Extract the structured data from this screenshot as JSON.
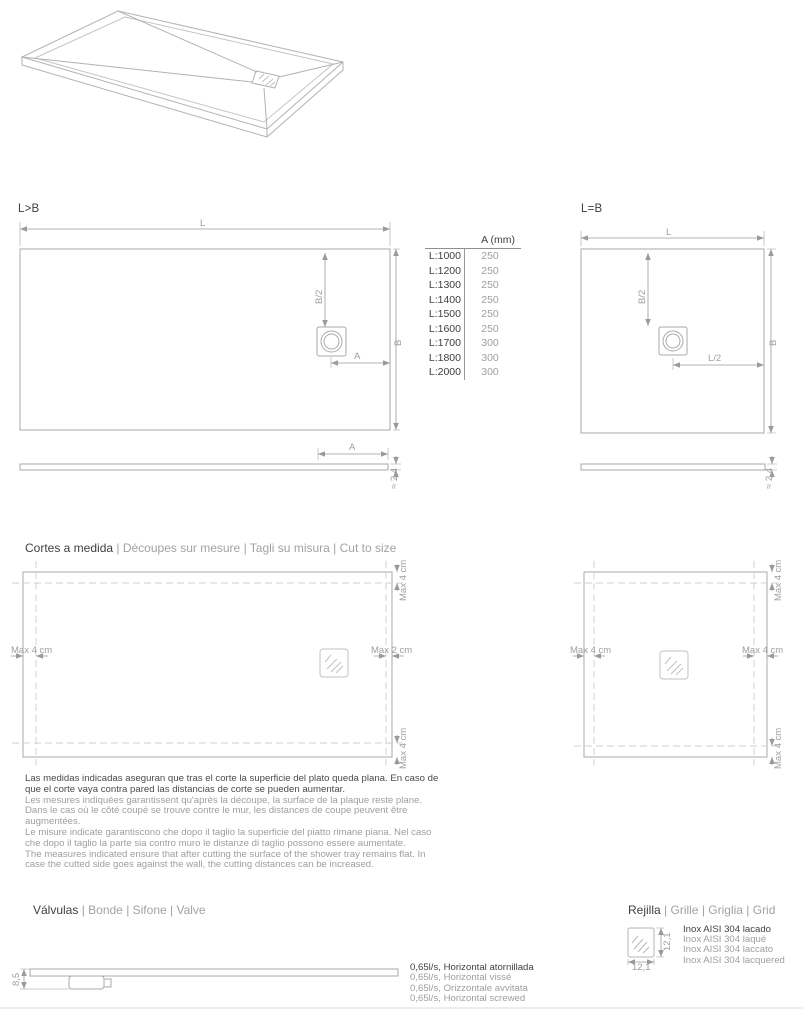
{
  "sections": {
    "lb": {
      "title": "L>B"
    },
    "eq": {
      "title": "L=B"
    },
    "cuts": {
      "title_primary": "Cortes a medida",
      "title_secondary": "| Découpes sur mesure | Tagli su misura | Cut to size"
    },
    "valves": {
      "title_primary": "Válvulas",
      "title_secondary": "| Bonde | Sifone | Valve"
    },
    "grid": {
      "title_primary": "Rejilla",
      "title_secondary": "| Grille | Griglia | Grid"
    }
  },
  "labels": {
    "L": "L",
    "B": "B",
    "B2": "B/2",
    "A": "A",
    "L2": "L/2",
    "thickness": "≈ 2,4",
    "valve_height": "8,5",
    "grid_size": "12,1",
    "max4": "Max 4 cm",
    "max2": "Max 2 cm"
  },
  "table": {
    "header": "A (mm)",
    "rows": [
      {
        "l": "L:1000",
        "a": "250"
      },
      {
        "l": "L:1200",
        "a": "250"
      },
      {
        "l": "L:1300",
        "a": "250"
      },
      {
        "l": "L:1400",
        "a": "250"
      },
      {
        "l": "L:1500",
        "a": "250"
      },
      {
        "l": "L:1600",
        "a": "250"
      },
      {
        "l": "L:1700",
        "a": "300"
      },
      {
        "l": "L:1800",
        "a": "300"
      },
      {
        "l": "L:2000",
        "a": "300"
      }
    ]
  },
  "measures_note": {
    "es": "Las medidas indicadas aseguran que tras el corte la superficie del plato queda plana. En caso de que el corte vaya contra pared las distancias de corte se pueden aumentar.",
    "fr": "Les mesures indiquées garantissent qu'après la découpe, la surface de la plaque reste plane. Dans le cas où le côté coupé se trouve contre le mur, les distances de coupe peuvent être augmentées.",
    "it": "Le misure indicate garantiscono che dopo il taglio la superficie del piatto rimane piana. Nel caso che dopo il taglio la parte sia contro muro le distanze di taglio possono essere aumentate.",
    "en": "The measures indicated ensure that after cutting the surface of the shower tray remains flat. In case the cutted side goes against the wall, the cutting distances can be increased."
  },
  "valve_specs": [
    "0,65l/s, Horizontal atornillada",
    "0,65l/s, Horizontal vissé",
    "0,65l/s, Orizzontale avvitata",
    "0,65l/s, Horizontal screwed"
  ],
  "grid_specs": [
    "Inox AISI 304 lacado",
    "Inox AISI 304 laqué",
    "Inox AISI 304 laccato",
    "Inox AISI 304 lacquered"
  ],
  "colors": {
    "dark_text": "#3f3f3f",
    "muted_text": "#9e9e9e",
    "line": "#a9a9a9",
    "dashed_line": "#cfcfcf"
  }
}
